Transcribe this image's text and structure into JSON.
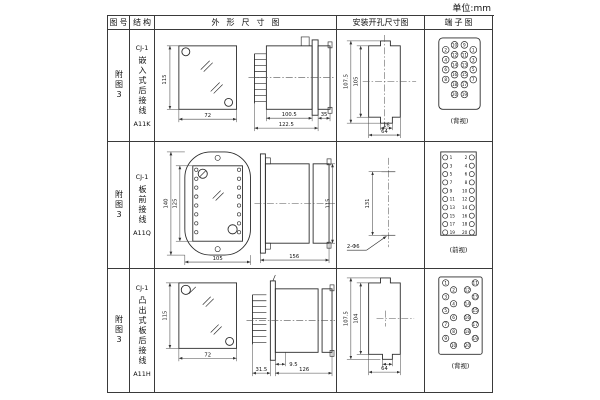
{
  "unit_label": "单位:mm",
  "header": {
    "fig": "图号",
    "structure": "结构",
    "outline": "外形尺寸图",
    "install": "安装开孔尺寸图",
    "terminal": "端子图"
  },
  "rows": [
    {
      "fig_no": "附图3",
      "model": "CJ-1",
      "mount_type": "嵌入式后接线",
      "code": "A11K",
      "outline": {
        "h": "115",
        "w": "72",
        "l1": "100.5",
        "l2": "122.5",
        "l3": "35"
      },
      "install": {
        "h1": "107.5",
        "h2": "105",
        "w1": "16",
        "w2": "64"
      },
      "terminal_caption": "(背视)"
    },
    {
      "fig_no": "附图3",
      "model": "CJ-1",
      "mount_type": "板前接线",
      "code": "A11Q",
      "outline": {
        "h1": "140",
        "h2": "125",
        "w": "105",
        "l": "156",
        "side_h": "115"
      },
      "install": {
        "span": "131",
        "hole_label": "2-Φ6"
      },
      "terminal_caption": "(前视)"
    },
    {
      "fig_no": "附图3",
      "model": "CJ-1",
      "mount_type": "凸出式板后接线",
      "code": "A11H",
      "outline": {
        "h": "115",
        "w": "72",
        "l1": "31.5",
        "l2": "9.5",
        "l3": "126"
      },
      "install": {
        "h1": "107.5",
        "h2": "104",
        "w": "64"
      },
      "terminal_caption": "(背视)"
    }
  ],
  "pins": {
    "a11k": {
      "outer_left": [
        "2",
        "4",
        "6",
        "8"
      ],
      "mid_left": [
        "10",
        "12",
        "14",
        "16",
        "18",
        "20"
      ],
      "mid_right": [
        "9",
        "11",
        "13",
        "15",
        "17",
        "19"
      ],
      "outer_right": [
        "1",
        "3",
        "5",
        "7"
      ]
    },
    "a11q": {
      "left": [
        "1",
        "3",
        "5",
        "7",
        "9",
        "11",
        "13",
        "15",
        "17",
        "19"
      ],
      "right": [
        "2",
        "4",
        "6",
        "8",
        "10",
        "12",
        "14",
        "16",
        "18",
        "20"
      ]
    },
    "a11h": {
      "left_outer": [
        "1",
        "3",
        "5",
        "7",
        "9"
      ],
      "left_inner": [
        "2",
        "4",
        "6",
        "8",
        "10"
      ],
      "right_inner": [
        "12",
        "14",
        "16",
        "18",
        "20"
      ],
      "right_outer": [
        "11",
        "13",
        "15",
        "17",
        "19"
      ]
    }
  }
}
